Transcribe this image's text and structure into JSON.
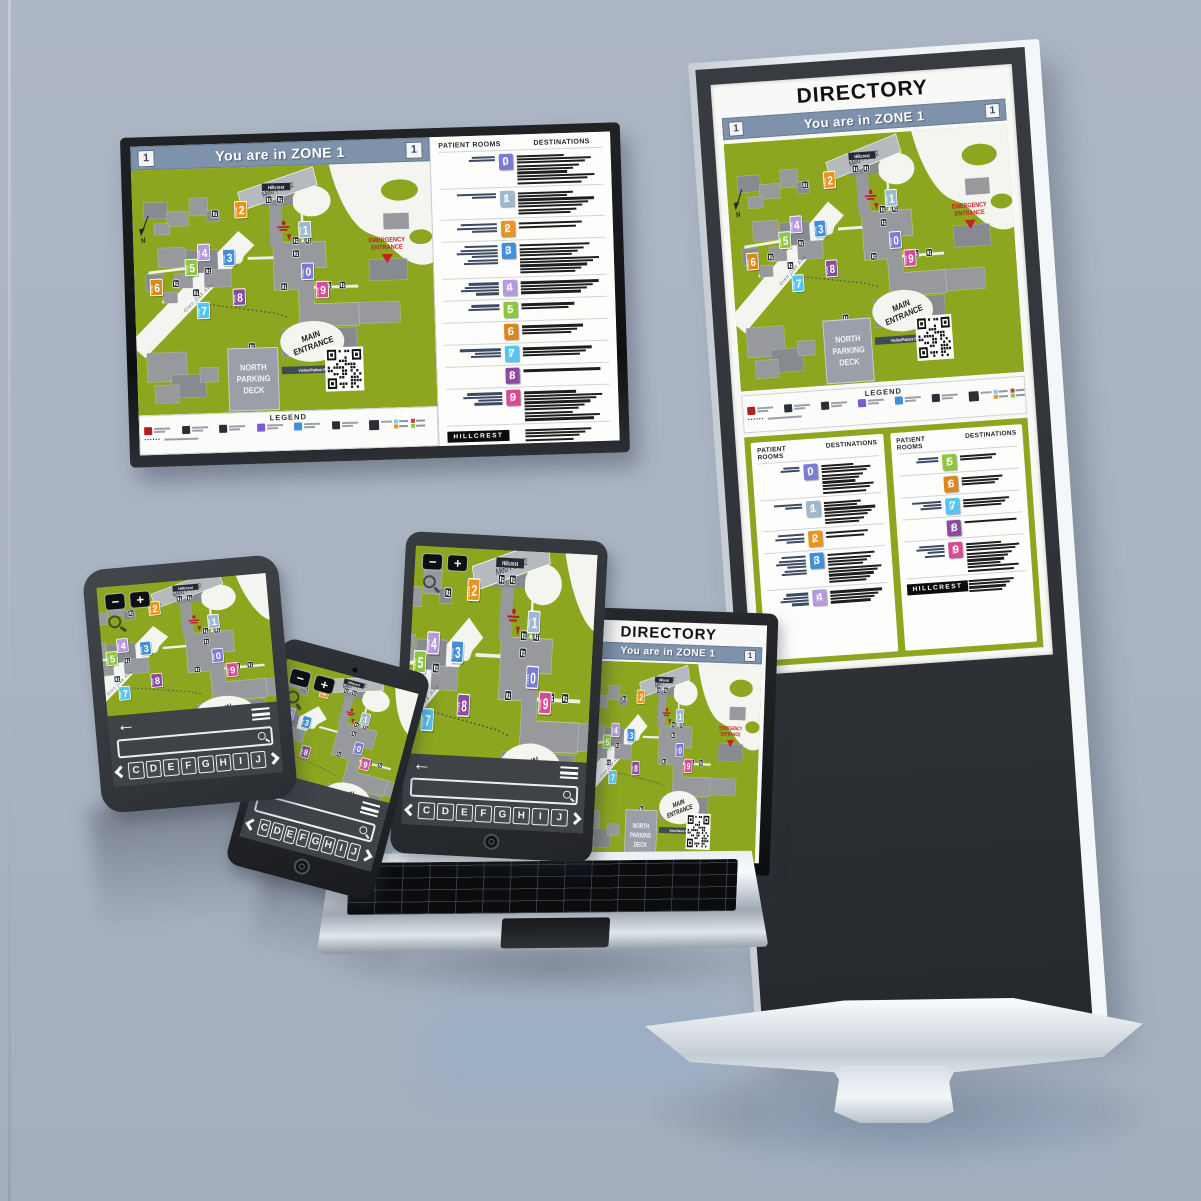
{
  "scene": {
    "wall_color": "#aeb7c5",
    "floor_color": "#a3aebe"
  },
  "kiosk": {
    "title": "DIRECTORY"
  },
  "map": {
    "header": {
      "text": "You are in ZONE 1",
      "badge": "1",
      "bar_color": "#7e93ab"
    },
    "colors": {
      "grass": "#8ca620",
      "building": "#97999d",
      "building_dark": "#878a8e",
      "road": "#f4f4f1",
      "parking": "#99a0aa"
    },
    "zone_word": "ZONE",
    "labels": {
      "med_park": "Med Park 2",
      "hillcrest": "Hillcrest",
      "emergency_line1": "EMERGENCY",
      "emergency_line2": "ENTRANCE",
      "main_line1": "MAIN",
      "main_line2": "ENTRANCE",
      "visitor_parking": "Visitor/Patient Parking",
      "parking_line1": "NORTH",
      "parking_line2": "PARKING",
      "parking_line3": "DECK",
      "street": "Glen Oak Ave",
      "north": "N"
    },
    "zones": [
      {
        "n": "0",
        "color": "#7b7bd4",
        "x": 243,
        "y": 130
      },
      {
        "n": "1",
        "color": "#9db9cf",
        "x": 241,
        "y": 79
      },
      {
        "n": "2",
        "color": "#e8941f",
        "x": 152,
        "y": 52
      },
      {
        "n": "3",
        "color": "#3f8fd9",
        "x": 133,
        "y": 110
      },
      {
        "n": "4",
        "color": "#b59add",
        "x": 98,
        "y": 103
      },
      {
        "n": "5",
        "color": "#8dc63f",
        "x": 80,
        "y": 121
      },
      {
        "n": "6",
        "color": "#d8881c",
        "x": 30,
        "y": 144
      },
      {
        "n": "7",
        "color": "#57c5f2",
        "x": 95,
        "y": 174
      },
      {
        "n": "8",
        "color": "#8c4a9e",
        "x": 146,
        "y": 159
      },
      {
        "n": "9",
        "color": "#d84a96",
        "x": 263,
        "y": 153
      }
    ],
    "legend": {
      "title": "LEGEND",
      "generic_items": 6,
      "icon_colors": [
        "#b02020",
        "#2a2f36",
        "#2a2f36",
        "#7a5bd0",
        "#3f8fd9",
        "#2a2f36"
      ],
      "places_icon_color": "#2a2f36",
      "chip_colors": [
        "#7ec7f0",
        "#c04040",
        "#e8941f",
        "#8dc63f"
      ],
      "tunnel_dots": "••••••"
    }
  },
  "directory": {
    "col_rooms": "PATIENT ROOMS",
    "col_dest": "DESTINATIONS",
    "brand": "HILLCREST",
    "rows": [
      {
        "zone": "0",
        "color": "#7b7bd4",
        "rooms": 2,
        "dests": 9
      },
      {
        "zone": "1",
        "color": "#9db9cf",
        "rooms": 2,
        "dests": 7
      },
      {
        "zone": "2",
        "color": "#e8941f",
        "rooms": 3,
        "dests": 2
      },
      {
        "zone": "3",
        "color": "#3f8fd9",
        "rooms": 6,
        "dests": 9
      },
      {
        "zone": "4",
        "color": "#b59add",
        "rooms": 4,
        "dests": 4
      },
      {
        "zone": "5",
        "color": "#8dc63f",
        "rooms": 2,
        "dests": 2
      },
      {
        "zone": "6",
        "color": "#d8881c",
        "rooms": 0,
        "dests": 3
      },
      {
        "zone": "7",
        "color": "#57c5f2",
        "rooms": 3,
        "dests": 3
      },
      {
        "zone": "8",
        "color": "#8c4a9e",
        "rooms": 0,
        "dests": 1
      },
      {
        "zone": "9",
        "color": "#d84a96",
        "rooms": 4,
        "dests": 9
      }
    ],
    "footer_dest_lines": 4
  },
  "mobile": {
    "zoom_out": "−",
    "zoom_in": "+",
    "back": "←",
    "keys": [
      "C",
      "D",
      "E",
      "F",
      "G",
      "H",
      "I",
      "J"
    ]
  }
}
